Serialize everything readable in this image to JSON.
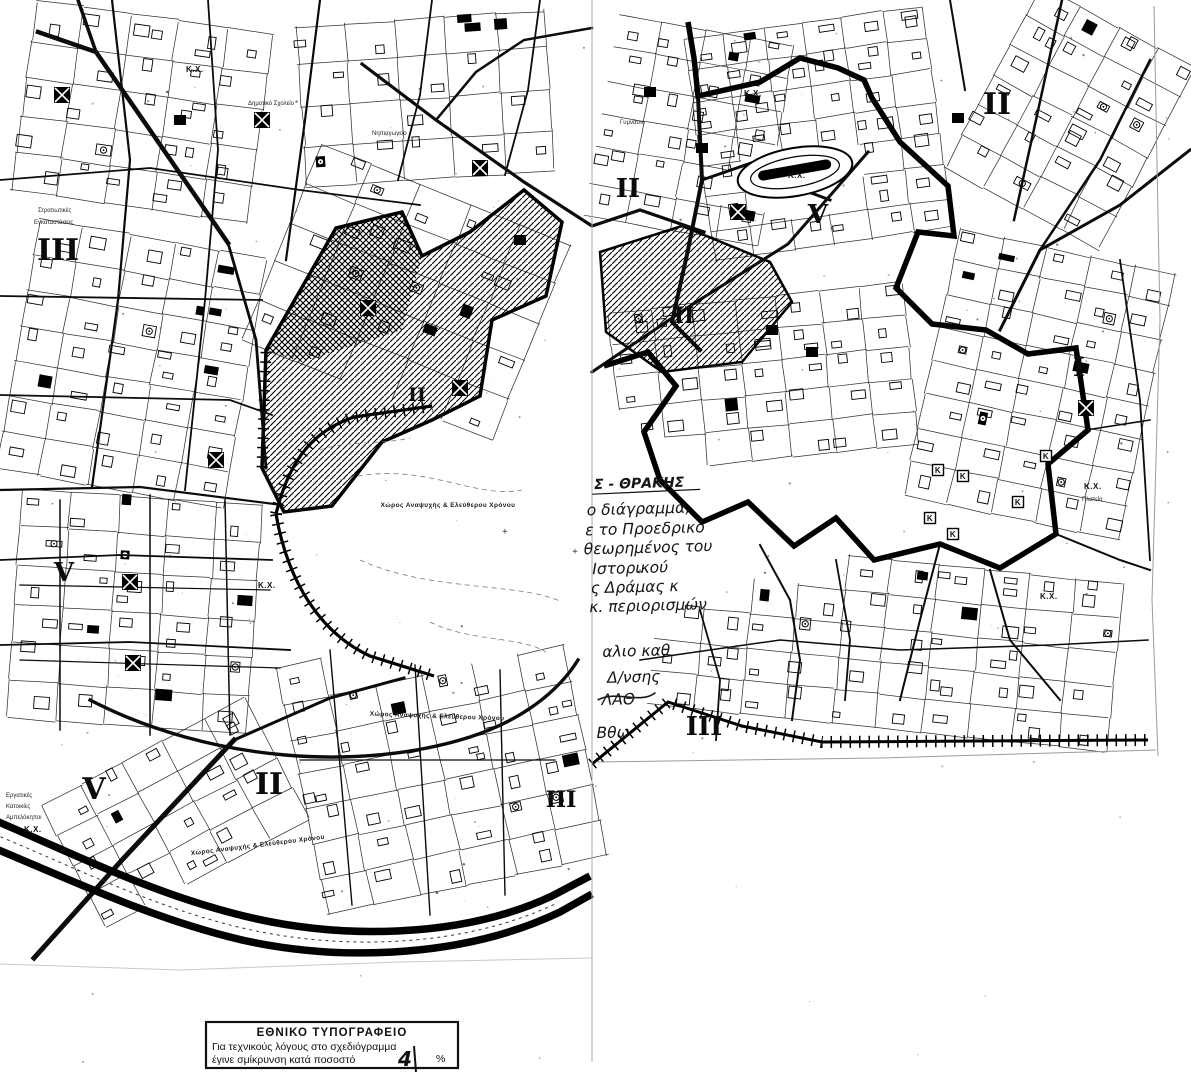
{
  "colors": {
    "paper": "#ffffff",
    "ink": "#0b0b0b",
    "faint": "#9a9a9a"
  },
  "map": {
    "zone_numerals": [
      "III",
      "II",
      "V",
      "II",
      "II",
      "II",
      "I",
      "V",
      "V",
      "II",
      "III",
      "III"
    ],
    "kx": "Κ.Χ.",
    "plateia": "Πλατεία",
    "k_box": "Κ",
    "open_space_label": "Χώρος Αναψυχής & Ελεύθερου Χρόνου",
    "lake_mark": "+",
    "small_labels": {
      "military1": "Στρατιωτικές",
      "military2": "Εγκαταστάσεις",
      "school": "Δημοτικό Σχολείο",
      "kindergarten": "Νηπιαγωγείο",
      "gymnasio": "Γυμνάσιο",
      "workers1": "Εργατικές",
      "workers2": "Κατοικίες",
      "workers3": "Αμπελόκηποι"
    },
    "handwriting": {
      "heading": "Σ - ΘΡΑΚΗΣ",
      "lines": [
        "ο διάγραμμα,",
        "ε το Προεδρικό",
        "θεωρημένος του",
        "Ιστορικού",
        "ς Δράμας κ",
        "κ. περιορισμών",
        "αλιο καθ",
        "Δ/νσης",
        "ΛΑΘ",
        "Βθω"
      ]
    }
  },
  "stamp": {
    "title": "ΕΘΝΙΚΟ ΤΥΠΟΓΡΑΦΕΙΟ",
    "line1": "Για τεχνικούς λόγους στο σχεδιόγραμμα",
    "line2": "έγινε σμίκρυνση κατά ποσοστό",
    "value": "4",
    "unit": "%"
  }
}
